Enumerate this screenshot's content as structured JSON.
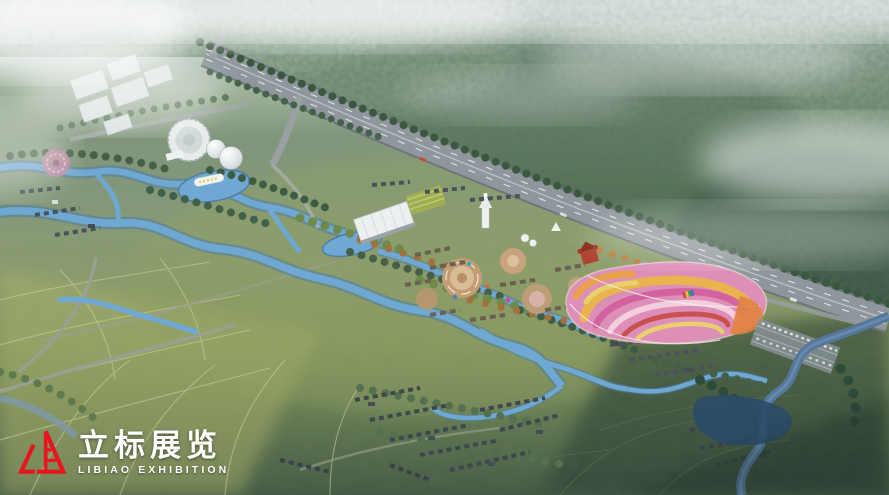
{
  "watermark": {
    "zh": "立标展览",
    "en": "LIBIAO EXHIBITION",
    "logo_color": "#e8141e",
    "text_color": "#ffffff"
  },
  "scene": {
    "type": "aerial-masterplan-rendering",
    "regions": [
      {
        "name": "misty-forest-hills",
        "color": "#6e8569"
      },
      {
        "name": "highway",
        "color": "#8f979c"
      },
      {
        "name": "campus-white-buildings",
        "color": "#dce3e4"
      },
      {
        "name": "round-exhibition-hall",
        "color": "#e7eceb"
      },
      {
        "name": "wetland-water-channels",
        "color": "#6fa8d2"
      },
      {
        "name": "central-exhibition-hall",
        "color": "#edf0f1"
      },
      {
        "name": "white-pagoda",
        "color": "#f0f2f2"
      },
      {
        "name": "red-castle",
        "color": "#b04030"
      },
      {
        "name": "theme-park-plaza",
        "color": "#c49d76"
      },
      {
        "name": "flower-fields-base",
        "color": "#dd8fb8"
      },
      {
        "name": "flower-band-orange",
        "color": "#e9b44e"
      },
      {
        "name": "flower-band-magenta",
        "color": "#d263a0"
      },
      {
        "name": "flower-band-red",
        "color": "#c8504e"
      },
      {
        "name": "flower-band-yellow",
        "color": "#e8d06c"
      },
      {
        "name": "farmland-fields",
        "color": "#9dab66"
      },
      {
        "name": "village-roofs",
        "color": "#434b52"
      },
      {
        "name": "river",
        "color": "#54779a"
      },
      {
        "name": "mist",
        "color": "#ffffff"
      }
    ]
  }
}
